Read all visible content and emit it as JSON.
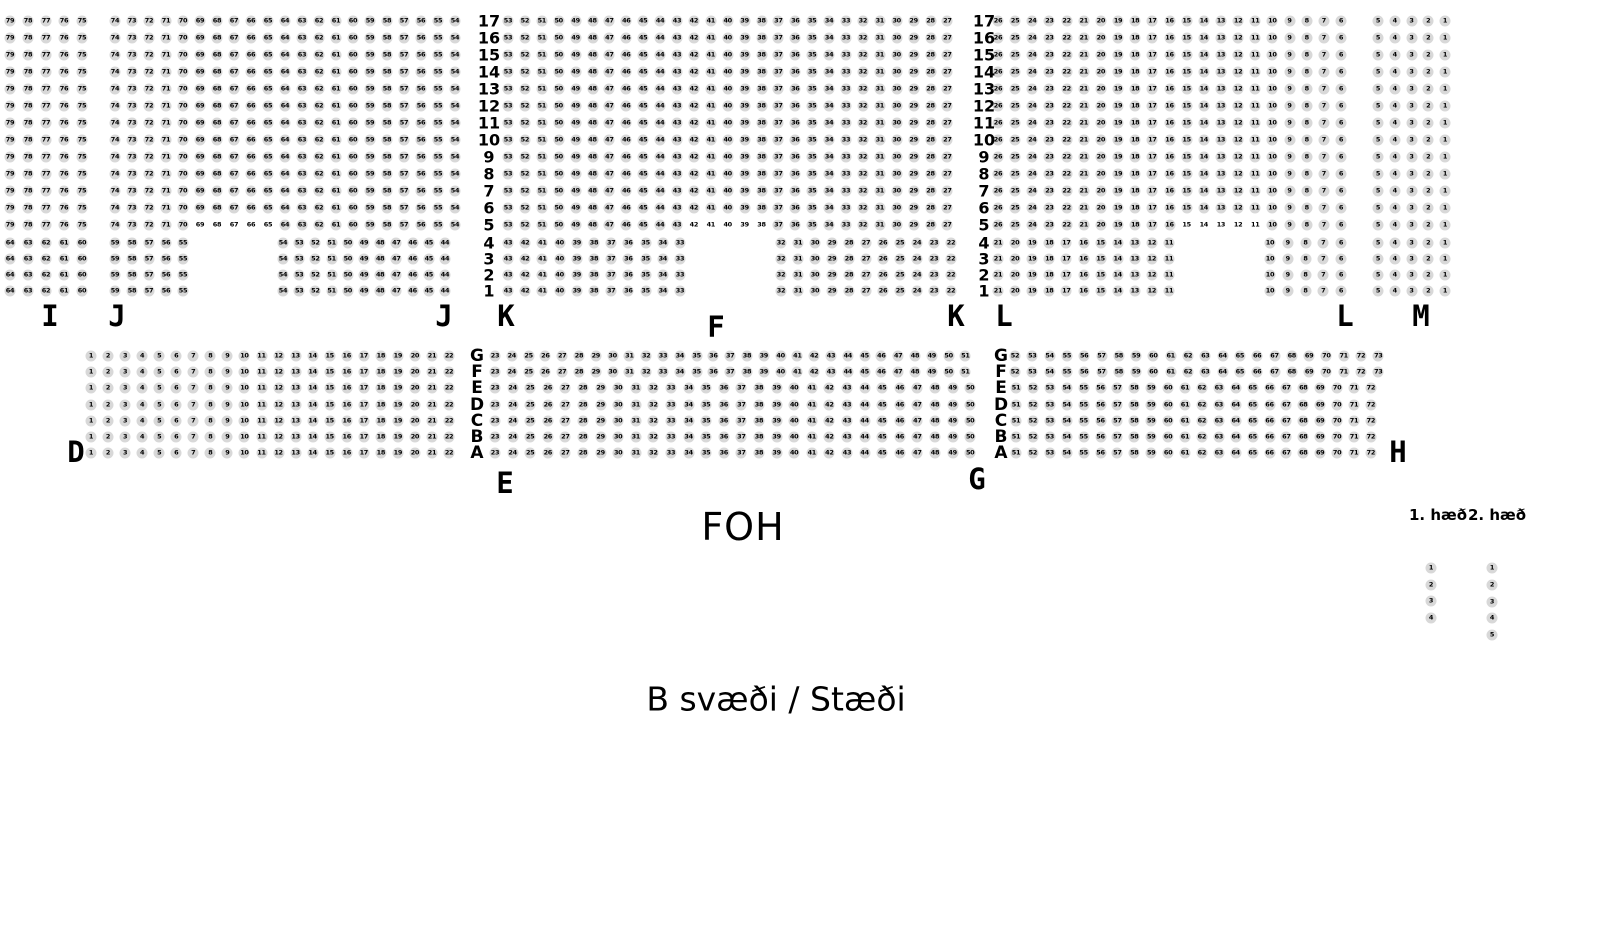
{
  "labels": {
    "title": "B svæði / Stæði",
    "foh": "FOH",
    "floor1": "1. hæð",
    "floor2": "2. hæð"
  },
  "colors": {
    "background": "#ffffff",
    "seat_fill": "#d8d8d8",
    "seat_text": "#000000",
    "label_text": "#000000"
  },
  "seat_map": {
    "area_letters": [
      {
        "text": "I",
        "x": 50,
        "y": 316
      },
      {
        "text": "J",
        "x": 117,
        "y": 316
      },
      {
        "text": "J",
        "x": 444,
        "y": 316
      },
      {
        "text": "K",
        "x": 506,
        "y": 316
      },
      {
        "text": "K",
        "x": 956,
        "y": 316
      },
      {
        "text": "L",
        "x": 1004,
        "y": 316
      },
      {
        "text": "L",
        "x": 1345,
        "y": 316
      },
      {
        "text": "M",
        "x": 1421,
        "y": 316
      },
      {
        "text": "F",
        "x": 716,
        "y": 327
      },
      {
        "text": "D",
        "x": 76,
        "y": 452
      },
      {
        "text": "E",
        "x": 505,
        "y": 483
      },
      {
        "text": "G",
        "x": 977,
        "y": 479
      },
      {
        "text": "H",
        "x": 1398,
        "y": 452
      }
    ],
    "row_label_columns": [
      {
        "x": 489,
        "groups": [
          {
            "y0": 21,
            "dy": 17,
            "labels": [
              "17",
              "16",
              "15",
              "14",
              "13",
              "12",
              "11",
              "10",
              "9",
              "8",
              "7",
              "6",
              "5"
            ]
          },
          {
            "y0": 243,
            "dy": 16,
            "labels": [
              "4",
              "3",
              "2",
              "1"
            ]
          }
        ]
      },
      {
        "x": 984,
        "groups": [
          {
            "y0": 21,
            "dy": 17,
            "labels": [
              "17",
              "16",
              "15",
              "14",
              "13",
              "12",
              "11",
              "10",
              "9",
              "8",
              "7",
              "6",
              "5"
            ]
          },
          {
            "y0": 243,
            "dy": 16,
            "labels": [
              "4",
              "3",
              "2",
              "1"
            ]
          }
        ]
      }
    ],
    "letter_columns": [
      {
        "x": 477,
        "groups": [
          {
            "y0": 356,
            "dy": 16.2,
            "labels": [
              "G",
              "F",
              "E",
              "D",
              "C",
              "B",
              "A"
            ]
          }
        ]
      },
      {
        "x": 1001,
        "groups": [
          {
            "y0": 356,
            "dy": 16.2,
            "labels": [
              "G",
              "F",
              "E",
              "D",
              "C",
              "B",
              "A"
            ]
          }
        ]
      }
    ],
    "blocks": [
      {
        "name": "I",
        "groups": [
          {
            "rows": 13,
            "y0": 21,
            "dy": 17,
            "segments": [
              {
                "x": 10,
                "dx": 18,
                "from": 79,
                "to": 75
              }
            ]
          },
          {
            "rows": 4,
            "y0": 243,
            "dy": 16,
            "segments": [
              {
                "x": 10,
                "dx": 18,
                "from": 64,
                "to": 60
              }
            ]
          }
        ]
      },
      {
        "name": "J",
        "groups": [
          {
            "rows": 12,
            "y0": 21,
            "dy": 17,
            "segments": [
              {
                "x": 115,
                "dx": 17,
                "from": 74,
                "to": 54
              }
            ]
          },
          {
            "rows": 1,
            "y0": 225,
            "dy": 16,
            "segments": [
              {
                "x": 115,
                "dx": 17,
                "from": 74,
                "to": 54,
                "plain": [
                  69,
                  65
                ]
              }
            ]
          },
          {
            "rows": 4,
            "y0": 243,
            "dy": 16,
            "segments": [
              {
                "x": 115,
                "dx": 17,
                "from": 59,
                "to": 55
              },
              {
                "x": 283,
                "dx": 16.2,
                "from": 54,
                "to": 44
              }
            ]
          }
        ]
      },
      {
        "name": "K",
        "groups": [
          {
            "rows": 12,
            "y0": 21,
            "dy": 17,
            "segments": [
              {
                "x": 508,
                "dx": 16.9,
                "from": 53,
                "to": 27
              }
            ]
          },
          {
            "rows": 1,
            "y0": 225,
            "dy": 16,
            "segments": [
              {
                "x": 508,
                "dx": 16.9,
                "from": 53,
                "to": 27,
                "plain": [
                  42,
                  38
                ]
              }
            ]
          },
          {
            "rows": 4,
            "y0": 243,
            "dy": 16,
            "segments": [
              {
                "x": 508,
                "dx": 17.2,
                "from": 43,
                "to": 33
              },
              {
                "x": 781,
                "dx": 17,
                "from": 32,
                "to": 22
              }
            ]
          }
        ]
      },
      {
        "name": "L",
        "groups": [
          {
            "rows": 12,
            "y0": 21,
            "dy": 17,
            "segments": [
              {
                "x": 998,
                "dx": 17.15,
                "from": 26,
                "to": 6
              }
            ]
          },
          {
            "rows": 1,
            "y0": 225,
            "dy": 16,
            "segments": [
              {
                "x": 998,
                "dx": 17.15,
                "from": 26,
                "to": 6,
                "plain": [
                  15,
                  11
                ]
              }
            ]
          },
          {
            "rows": 4,
            "y0": 243,
            "dy": 16,
            "segments": [
              {
                "x": 998,
                "dx": 17.1,
                "from": 21,
                "to": 11
              },
              {
                "x": 1270,
                "dx": 17.75,
                "from": 10,
                "to": 6
              }
            ]
          }
        ]
      },
      {
        "name": "M",
        "groups": [
          {
            "rows": 13,
            "y0": 21,
            "dy": 17,
            "segments": [
              {
                "x": 1378,
                "dx": 16.75,
                "from": 5,
                "to": 1
              }
            ]
          },
          {
            "rows": 4,
            "y0": 243,
            "dy": 16,
            "segments": [
              {
                "x": 1378,
                "dx": 16.75,
                "from": 5,
                "to": 1
              }
            ]
          }
        ]
      },
      {
        "name": "D-E",
        "groups": [
          {
            "rows": 7,
            "y0": 356,
            "dy": 16.2,
            "segments": [
              {
                "x": 91,
                "dx": 17.05,
                "from": 1,
                "to": 22
              }
            ]
          }
        ]
      },
      {
        "name": "E-G",
        "groups": [
          {
            "rows": 2,
            "y0": 356,
            "dy": 16.2,
            "segments": [
              {
                "x": 495,
                "dx": 16.8,
                "from": 23,
                "to": 51
              }
            ]
          },
          {
            "rows": 5,
            "y0": 388.4,
            "dy": 16.2,
            "segments": [
              {
                "x": 495,
                "dx": 17.6,
                "from": 23,
                "to": 50
              }
            ]
          }
        ]
      },
      {
        "name": "G-H",
        "groups": [
          {
            "rows": 2,
            "y0": 356,
            "dy": 16.2,
            "segments": [
              {
                "x": 1015,
                "dx": 17.3,
                "from": 52,
                "to": 73
              }
            ]
          },
          {
            "rows": 5,
            "y0": 388.4,
            "dy": 16.2,
            "segments": [
              {
                "x": 1016,
                "dx": 16.9,
                "from": 51,
                "to": 72
              }
            ]
          }
        ]
      },
      {
        "name": "floor-1",
        "groups": [
          {
            "rows": 4,
            "y0": 568,
            "dy": 16.7,
            "segments": [
              {
                "x": 1431,
                "dx": 0,
                "from": 1,
                "to": 1,
                "row_increment": true
              }
            ]
          }
        ]
      },
      {
        "name": "floor-2",
        "groups": [
          {
            "rows": 5,
            "y0": 568,
            "dy": 16.75,
            "segments": [
              {
                "x": 1492,
                "dx": 0,
                "from": 1,
                "to": 1,
                "row_increment": true
              }
            ]
          }
        ]
      }
    ]
  }
}
